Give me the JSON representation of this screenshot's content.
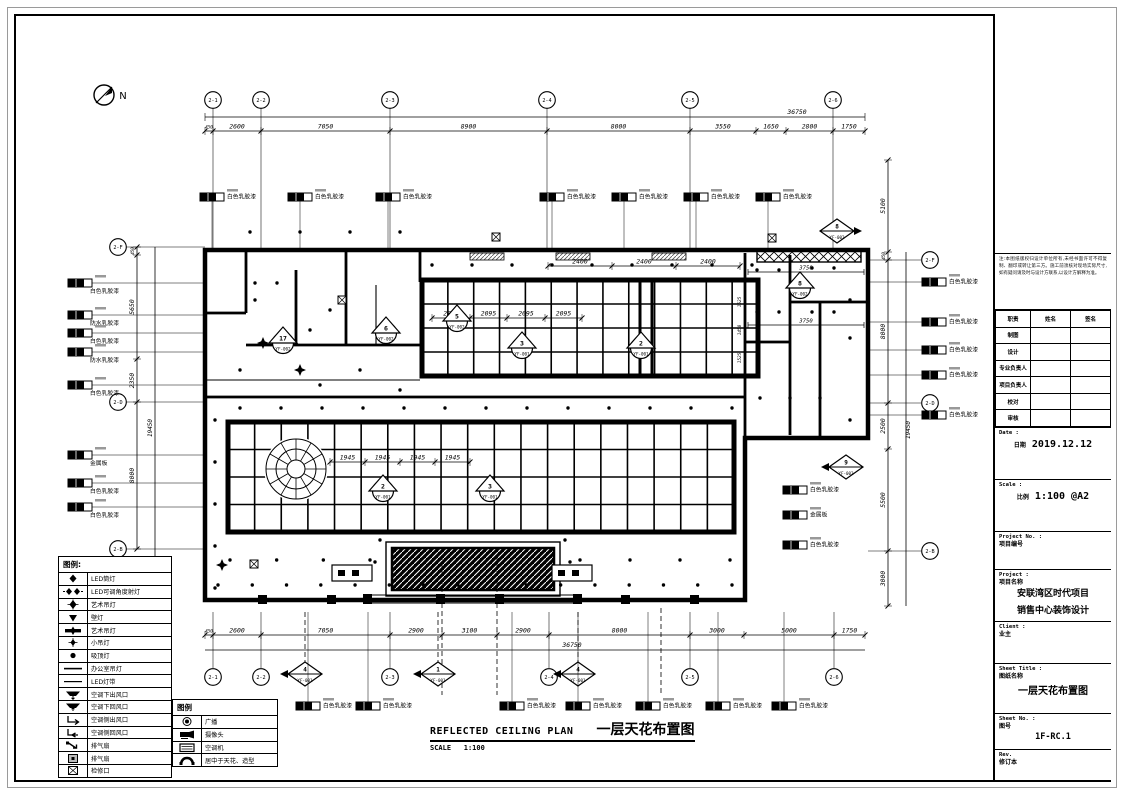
{
  "north_label": "N",
  "drawing": {
    "title_en": "REFLECTED CEILING PLAN",
    "title_zh": "一层天花布置图",
    "scale_label": "SCALE",
    "scale_value": "1:100"
  },
  "axes": {
    "top": {
      "overall": "36750",
      "dims": [
        "450",
        "2600",
        "7050",
        "8900",
        "8000",
        "3550",
        "1650",
        "2800",
        "1750"
      ],
      "bubbles": [
        "2-1",
        "2-2",
        "2-3",
        "2-4",
        "2-5",
        "2-6"
      ]
    },
    "bottom": {
      "overall": "36750",
      "dims": [
        "450",
        "2600",
        "7050",
        "2900",
        "3100",
        "2900",
        "8000",
        "3000",
        "5000",
        "1750"
      ],
      "bubbles": [
        "2-1",
        "2-2",
        "2-3",
        "2-4",
        "2-5",
        "2-6"
      ]
    },
    "left": {
      "overall": "19450",
      "dims": [
        "450",
        "5650",
        "2350",
        "8000"
      ],
      "bubbles": [
        "2-F",
        "2-D",
        "2-B"
      ]
    },
    "right": {
      "overall": "19450",
      "dims": [
        "5100",
        "450",
        "8000",
        "2500",
        "5500",
        "3000"
      ],
      "bubbles": [
        "2-F",
        "2-D",
        "2-B"
      ]
    }
  },
  "inner_dims": {
    "coffer1_top": [
      "2400",
      "2400",
      "2400"
    ],
    "coffer1_mid": [
      "2095",
      "2095",
      "2095",
      "2095"
    ],
    "coffer1_right": [
      "1525",
      "1450",
      "1525"
    ],
    "coffer2_mid": [
      "1945",
      "1945",
      "1945",
      "1945"
    ],
    "right_room": [
      "3750",
      "3750"
    ]
  },
  "markers": [
    {
      "type": "tri",
      "num": "17",
      "code": "YF-002",
      "x": 283,
      "y": 342
    },
    {
      "type": "tri",
      "num": "6",
      "code": "YF-002",
      "x": 386,
      "y": 332
    },
    {
      "type": "tri",
      "num": "5",
      "code": "YF-002",
      "x": 457,
      "y": 320
    },
    {
      "type": "tri",
      "num": "3",
      "code": "YF-001",
      "x": 522,
      "y": 347
    },
    {
      "type": "tri",
      "num": "2",
      "code": "YF-001",
      "x": 641,
      "y": 347
    },
    {
      "type": "tri",
      "num": "8",
      "code": "YF-002",
      "x": 800,
      "y": 287
    },
    {
      "type": "tri",
      "num": "2",
      "code": "YF-001",
      "x": 383,
      "y": 490
    },
    {
      "type": "tri",
      "num": "3",
      "code": "YF-001",
      "x": 490,
      "y": 490
    },
    {
      "type": "dia",
      "num": "8",
      "code": "YF-002",
      "dir": "r",
      "x": 837,
      "y": 231
    },
    {
      "type": "dia",
      "num": "9",
      "code": "YF-002",
      "dir": "l",
      "x": 846,
      "y": 467
    },
    {
      "type": "dia",
      "num": "4",
      "code": "YF-001",
      "dir": "l",
      "x": 305,
      "y": 674
    },
    {
      "type": "dia",
      "num": "1",
      "code": "YF-001",
      "dir": "l",
      "x": 438,
      "y": 674
    },
    {
      "type": "dia",
      "num": "4",
      "code": "YF-001",
      "dir": "l",
      "x": 578,
      "y": 674
    }
  ],
  "keynotes": [
    {
      "x": 200,
      "y": 197,
      "label": "白色乳胶漆",
      "col": "top"
    },
    {
      "x": 288,
      "y": 197,
      "label": "白色乳胶漆",
      "col": "top"
    },
    {
      "x": 376,
      "y": 197,
      "label": "白色乳胶漆",
      "col": "top"
    },
    {
      "x": 540,
      "y": 197,
      "label": "白色乳胶漆",
      "col": "top"
    },
    {
      "x": 612,
      "y": 197,
      "label": "白色乳胶漆",
      "col": "top"
    },
    {
      "x": 684,
      "y": 197,
      "label": "白色乳胶漆",
      "col": "top"
    },
    {
      "x": 756,
      "y": 197,
      "label": "白色乳胶漆",
      "col": "top"
    },
    {
      "x": 68,
      "y": 283,
      "label": "白色乳胶漆",
      "col": "left"
    },
    {
      "x": 68,
      "y": 315,
      "label": "防水乳胶漆",
      "col": "left"
    },
    {
      "x": 68,
      "y": 333,
      "label": "白色乳胶漆",
      "col": "left"
    },
    {
      "x": 68,
      "y": 352,
      "label": "防水乳胶漆",
      "col": "left"
    },
    {
      "x": 68,
      "y": 385,
      "label": "白色乳胶漆",
      "col": "left"
    },
    {
      "x": 68,
      "y": 455,
      "label": "金属板",
      "col": "left"
    },
    {
      "x": 68,
      "y": 483,
      "label": "白色乳胶漆",
      "col": "left"
    },
    {
      "x": 68,
      "y": 507,
      "label": "白色乳胶漆",
      "col": "left"
    },
    {
      "x": 922,
      "y": 282,
      "label": "白色乳胶漆",
      "col": "rout"
    },
    {
      "x": 922,
      "y": 322,
      "label": "白色乳胶漆",
      "col": "rout"
    },
    {
      "x": 922,
      "y": 350,
      "label": "白色乳胶漆",
      "col": "rout"
    },
    {
      "x": 922,
      "y": 375,
      "label": "白色乳胶漆",
      "col": "rout"
    },
    {
      "x": 922,
      "y": 415,
      "label": "白色乳胶漆",
      "col": "rout"
    },
    {
      "x": 783,
      "y": 490,
      "label": "白色乳胶漆",
      "col": "rin"
    },
    {
      "x": 783,
      "y": 515,
      "label": "金属板",
      "col": "rin"
    },
    {
      "x": 783,
      "y": 545,
      "label": "白色乳胶漆",
      "col": "rin"
    },
    {
      "x": 296,
      "y": 706,
      "label": "白色乳胶漆",
      "col": "bottom"
    },
    {
      "x": 356,
      "y": 706,
      "label": "白色乳胶漆",
      "col": "bottom"
    },
    {
      "x": 500,
      "y": 706,
      "label": "白色乳胶漆",
      "col": "bottom"
    },
    {
      "x": 566,
      "y": 706,
      "label": "白色乳胶漆",
      "col": "bottom"
    },
    {
      "x": 636,
      "y": 706,
      "label": "白色乳胶漆",
      "col": "bottom"
    },
    {
      "x": 706,
      "y": 706,
      "label": "白色乳胶漆",
      "col": "bottom"
    },
    {
      "x": 772,
      "y": 706,
      "label": "白色乳胶漆",
      "col": "bottom"
    }
  ],
  "legend1": {
    "title": "图例:",
    "items": [
      {
        "icon": "led-downlight",
        "label": "LED筒灯"
      },
      {
        "icon": "led-adjustable",
        "label": "LED可调角度射灯"
      },
      {
        "icon": "art-pendant",
        "label": "艺术吊灯"
      },
      {
        "icon": "wall-lamp",
        "label": "壁灯"
      },
      {
        "icon": "art-pendant-bar",
        "label": "艺术吊灯"
      },
      {
        "icon": "small-pendant",
        "label": "小吊灯"
      },
      {
        "icon": "ceiling-lamp",
        "label": "吸顶灯"
      },
      {
        "icon": "office-pendant",
        "label": "办公室吊灯"
      },
      {
        "icon": "led-strip",
        "label": "LED灯带"
      },
      {
        "icon": "ac-down-supply",
        "label": "空调下出风口"
      },
      {
        "icon": "ac-down-return",
        "label": "空调下回风口"
      },
      {
        "icon": "ac-side-supply",
        "label": "空调侧出风口"
      },
      {
        "icon": "ac-side-return",
        "label": "空调侧回风口"
      },
      {
        "icon": "exhaust-fan",
        "label": "排气扇"
      },
      {
        "icon": "exhaust-fan-2",
        "label": "排气扇"
      },
      {
        "icon": "access-panel",
        "label": "检修口"
      }
    ]
  },
  "legend2": {
    "title": "图例",
    "items": [
      {
        "icon": "speaker",
        "label": "广播"
      },
      {
        "icon": "camera",
        "label": "摄像头"
      },
      {
        "icon": "ac-unit",
        "label": "空调机"
      },
      {
        "icon": "handset",
        "label": "居中于天花、造型"
      }
    ]
  },
  "titleblock": {
    "notes": "注:本图纸版权归设计单位所有,未经书面许可不得复制、翻印或转让第三方。施工前须核对现场实际尺寸,如有疑问请及时与设计方联系,以设计方解释为准。",
    "sign_table": {
      "headers": [
        "职责",
        "姓名",
        "签名"
      ],
      "rows": [
        "制图",
        "设计",
        "专业负责人",
        "项目负责人",
        "校对",
        "审核"
      ]
    },
    "date_label": "Date :",
    "date_zh": "日期",
    "date_value": "2019.12.12",
    "scale_label": "Scale :",
    "scale_zh": "比例",
    "scale_value": "1:100 @A2",
    "project_no_label": "Project No. :",
    "project_no_zh": "项目编号",
    "project_label": "Project :",
    "project_zh": "项目名称",
    "project_name_line1": "安联湾区时代项目",
    "project_name_line2": "销售中心装饰设计",
    "client_label": "Client :",
    "client_zh": "业主",
    "sheet_title_label": "Sheet Title :",
    "sheet_title_zh": "图纸名称",
    "sheet_title_value": "一层天花布置图",
    "sheet_no_label": "Sheet No. :",
    "sheet_no_zh": "图号",
    "sheet_no_value": "1F-RC.1",
    "rev_label": "Rev.",
    "rev_zh": "修订本"
  }
}
